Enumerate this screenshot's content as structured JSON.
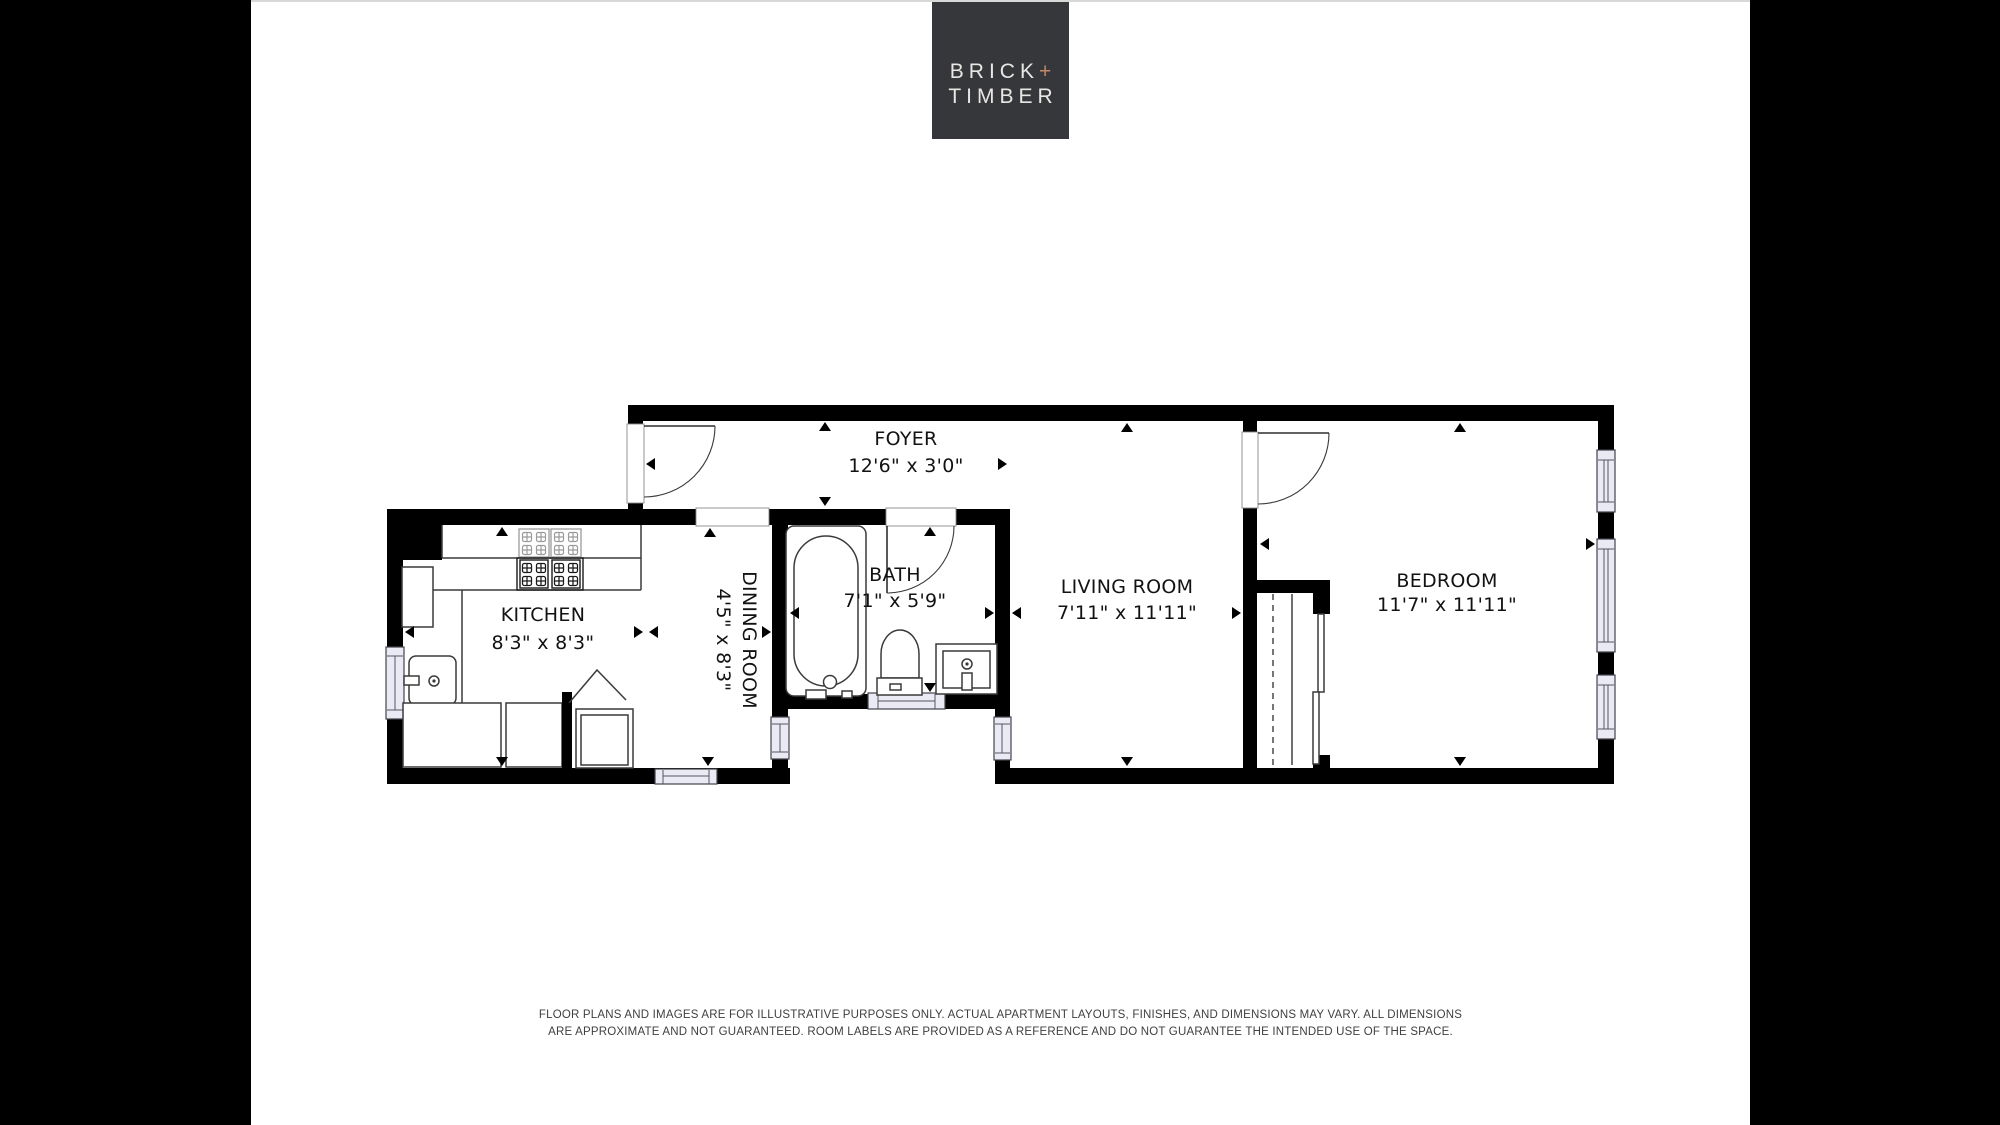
{
  "logo": {
    "brick": "BRICK",
    "plus": "+",
    "timber": "TIMBER"
  },
  "rooms": {
    "foyer": {
      "label": "FOYER",
      "dims": "12'6\" x 3'0\""
    },
    "kitchen": {
      "label": "KITCHEN",
      "dims": "8'3\" x 8'3\""
    },
    "dining": {
      "label": "DINING ROOM",
      "dims": "4'5\" x 8'3\""
    },
    "bath": {
      "label": "BATH",
      "dims": "7'1\" x 5'9\""
    },
    "living": {
      "label": "LIVING ROOM",
      "dims": "7'11\" x 11'11\""
    },
    "bedroom": {
      "label": "BEDROOM",
      "dims": "11'7\" x 11'11\""
    }
  },
  "disclaimer": {
    "line1": "FLOOR PLANS AND IMAGES ARE FOR ILLUSTRATIVE PURPOSES ONLY. ACTUAL APARTMENT LAYOUTS, FINISHES, AND DIMENSIONS MAY VARY. ALL DIMENSIONS",
    "line2": "ARE APPROXIMATE AND NOT GUARANTEED. ROOM LABELS ARE PROVIDED AS A REFERENCE AND DO NOT GUARANTEE THE INTENDED USE OF THE SPACE."
  },
  "colors": {
    "page_bg": "#000000",
    "canvas_bg": "#ffffff",
    "wall": "#000000",
    "window_fill": "#e9eaf4",
    "logo_bg": "#35373a",
    "logo_text": "#e9e7e4",
    "logo_plus": "#c2886a",
    "disclaimer_text": "#3f3f3f"
  }
}
